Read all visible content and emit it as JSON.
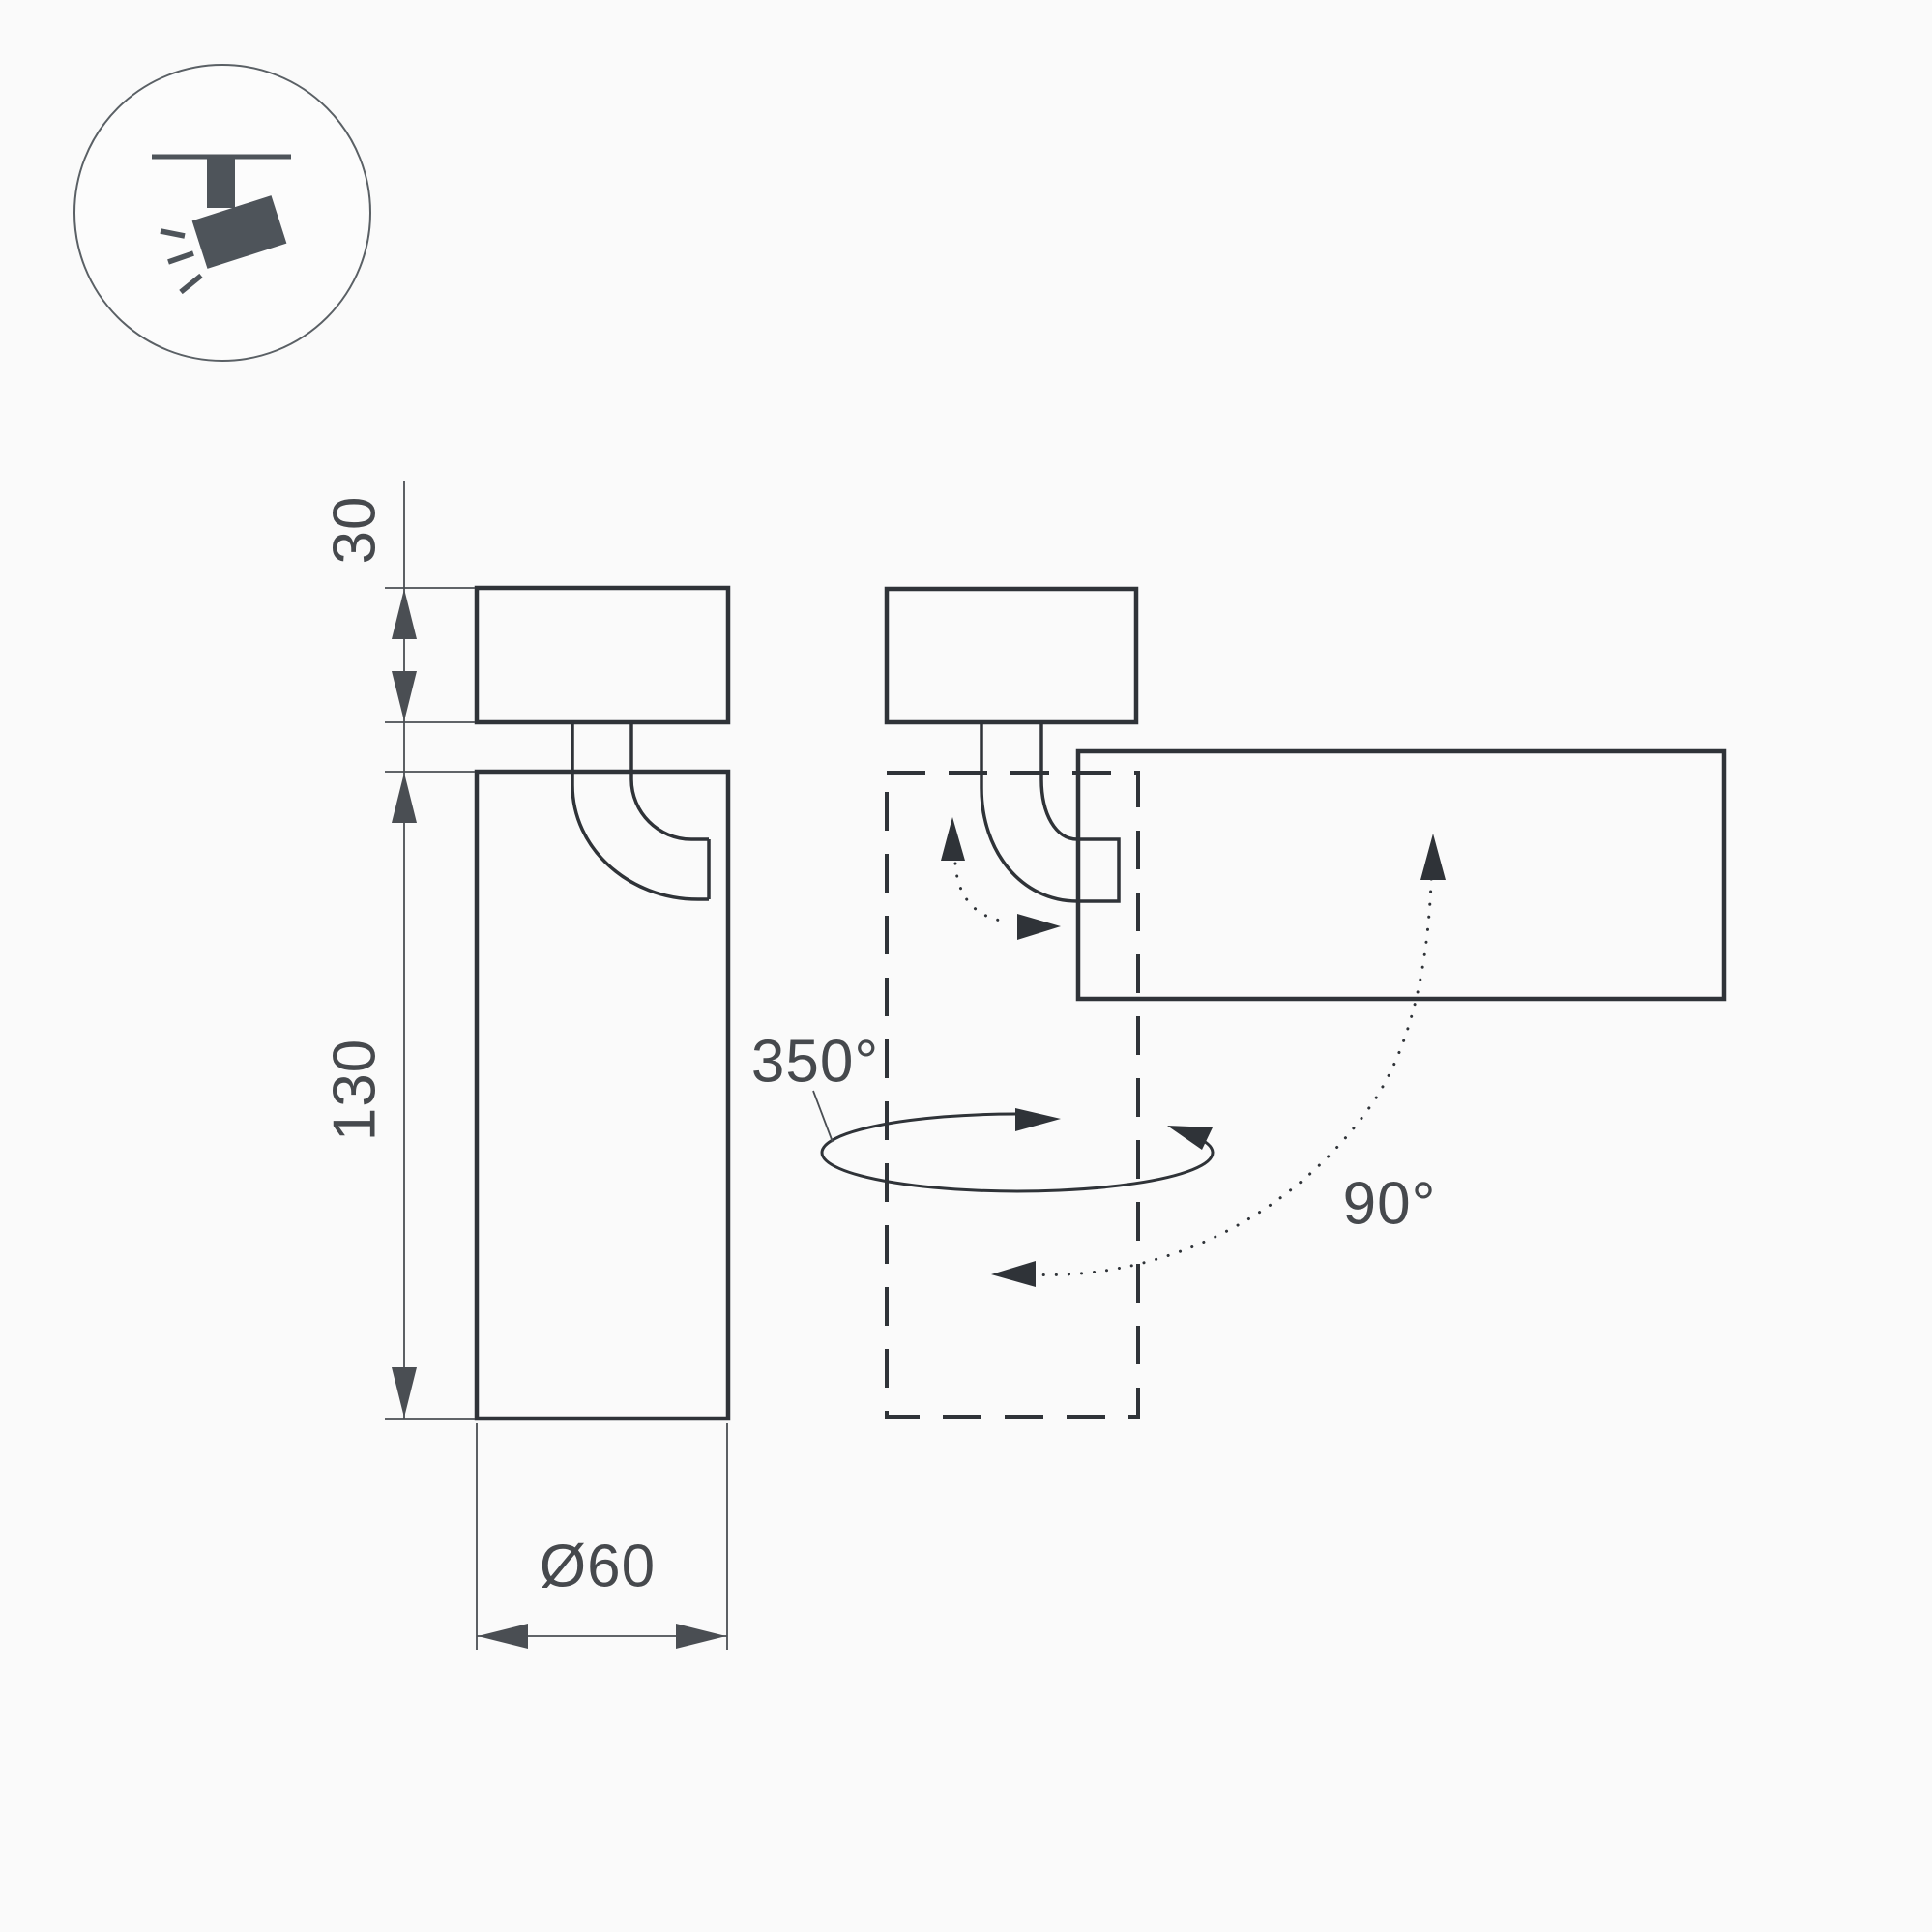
{
  "icon": {
    "semantic": "ceiling-track-spotlight"
  },
  "dimensions": {
    "mount_height": "30",
    "body_height": "130",
    "body_diameter": "Ø60"
  },
  "rotation": {
    "pan_angle": "350°",
    "tilt_angle": "90°"
  },
  "colors": {
    "bg": "#fafafa",
    "line": "#2f3338",
    "dim-line": "#4a4e53",
    "text": "#46494d",
    "icon-fill": "#4e545a"
  }
}
